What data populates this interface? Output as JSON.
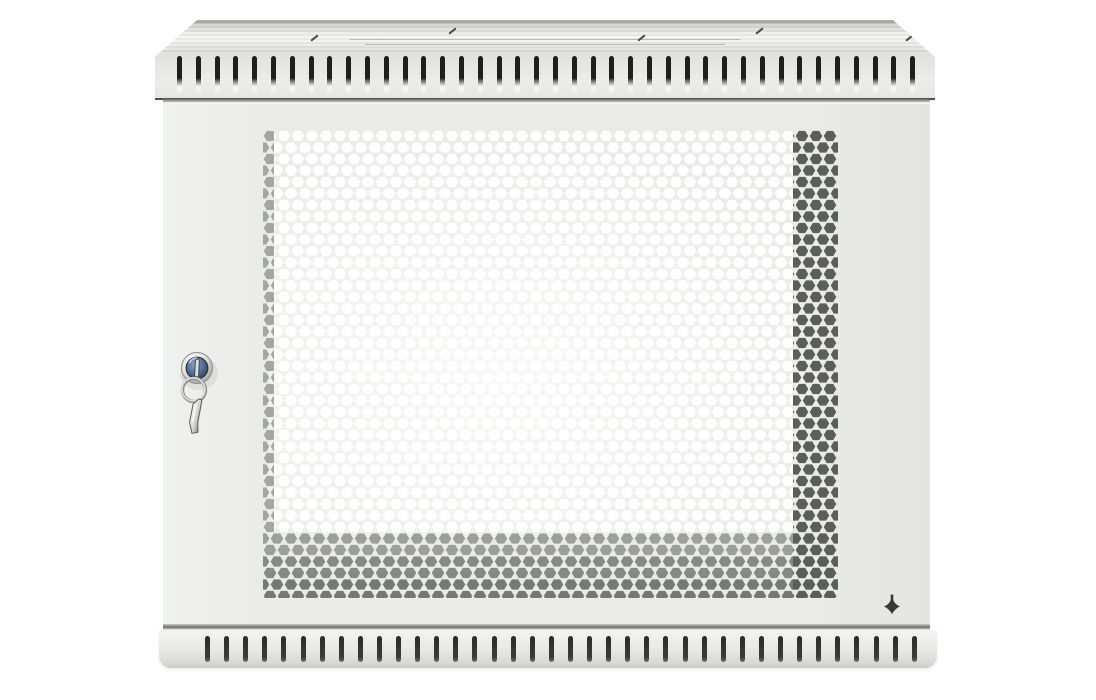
{
  "scene": {
    "kind": "product-photo",
    "subject": "wall-mount network cabinet",
    "caption": "Grey wall-mounted 19-inch network cabinet, closed front door with hexagonal perforated mesh panel, cam lock with key ring and key, ventilation slot grilles on the top and bottom panels",
    "background_color": "#ffffff"
  },
  "cabinet": {
    "panel_color": "#ebebe9",
    "top_panel": {
      "vent_slot_count": 40,
      "knockout_mark_count": 5
    },
    "front_door": {
      "perforation_pattern": "hexagonal",
      "hole_color_center": "#ffffff",
      "hole_color_bottom_band": "#858a84",
      "hole_color_right_band": "#5a5f59",
      "lock": {
        "type": "cam-lock",
        "face_color": "#3c5a7a",
        "keys_on_ring": 1
      },
      "ground_hole_shape": "four-point-star"
    },
    "bottom_panel": {
      "vent_slot_count": 38
    }
  },
  "colors": {
    "bg": "#ffffff",
    "panel": "#ebebe9",
    "slot_dark": "#1f1f1d",
    "hex_white": "#ffffff",
    "hex_left": "#a2a7a1",
    "hex_g1": "#9ba09a",
    "hex_g2": "#858a84",
    "hex_g3": "#747973",
    "hex_dark": "#5a5f59",
    "cross_hole": "#38383 6",
    "cross": "#383836"
  }
}
